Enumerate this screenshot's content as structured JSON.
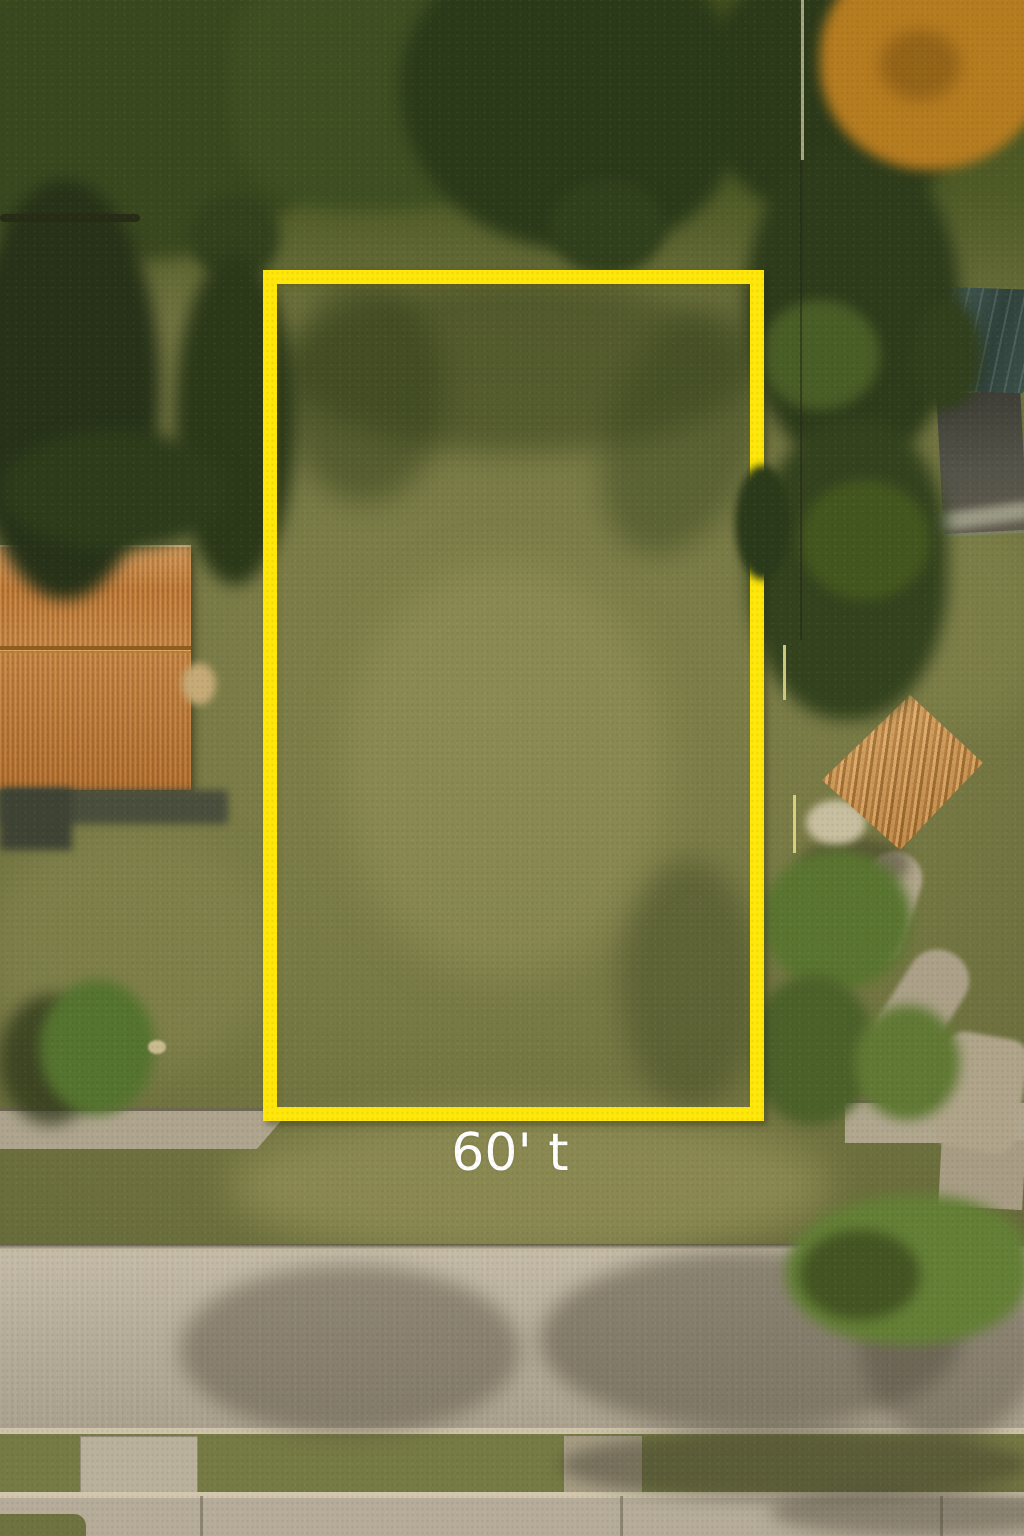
{
  "annotation": {
    "dimension_label": "60' t",
    "label_color": "#ffffff",
    "lot_outline_color": "#ffe70a",
    "lot_outline_shape": "rectangle"
  },
  "scene": {
    "type": "aerial-drone-photo",
    "subject": "vacant-grass-lot-outlined-in-yellow",
    "regions": [
      "vacant-lot-grass",
      "tree-canopy-top",
      "autumn-orange-tree",
      "left-house-orange-metal-roof",
      "right-shed-orange-roof",
      "teal-tarp",
      "asphalt-driveway-top-right",
      "gravel-path-right",
      "far-sidewalk",
      "street-road",
      "grass-verge",
      "near-sidewalk",
      "driveway-pad",
      "tree-shadows-on-road",
      "utility-wire"
    ],
    "palette": {
      "grass_light": "#8a8a52",
      "grass_dark": "#4e5a28",
      "tree_dark": "#2b3a19",
      "tree_light": "#6b8038",
      "autumn_tree": "#b67c20",
      "roof_orange": "#c07c3c",
      "road": "#b5ab98",
      "sidewalk": "#b2a892",
      "tarp_teal": "#3f5a52",
      "outline_yellow": "#ffe70a"
    }
  }
}
